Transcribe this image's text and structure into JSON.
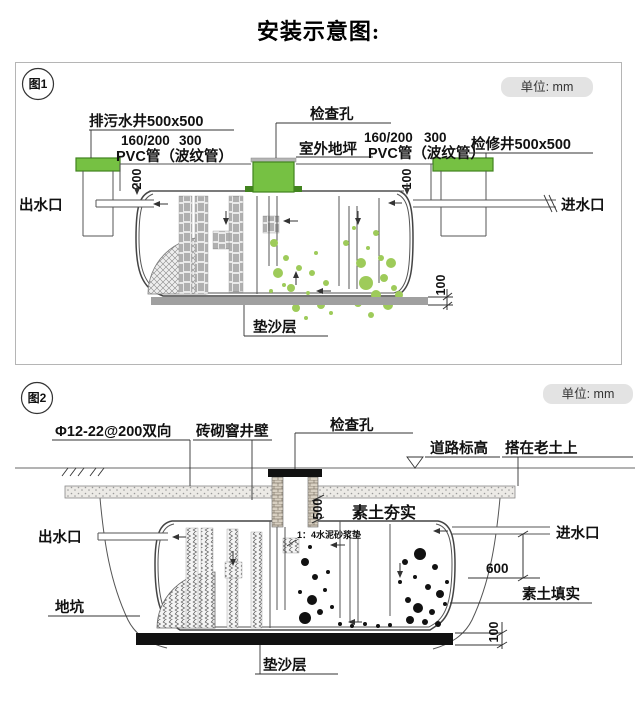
{
  "title": "安装示意图:",
  "fig1": {
    "tag": "图1",
    "unit_badge": "单位: mm",
    "labels": {
      "sewage_well": "排污水井500x500",
      "pvc_left_d1": "160/200",
      "pvc_left_d2": "300",
      "pvc_left": "PVC管（波纹管）",
      "inspection_hole": "检查孔",
      "outdoor_ground": "室外地坪",
      "pvc_right_d1": "160/200",
      "pvc_right_d2": "300",
      "pvc_right": "PVC管（波纹管）",
      "access_well": "检修井500x500",
      "outlet": "出水口",
      "inlet": "进水口",
      "sand_layer": "垫沙层"
    },
    "dims": {
      "d200": "200",
      "d100_top": "100",
      "d100_bottom": "100"
    }
  },
  "fig2": {
    "tag": "图2",
    "unit_badge": "单位: mm",
    "labels": {
      "rebar": "Φ12-22@200双向",
      "brick_wall": "砖砌窨井壁",
      "inspection_hole": "检查孔",
      "road_level": "道路标高",
      "on_old_soil": "搭在老土上",
      "compacted_soil": "素土夯实",
      "mortar_pad": "1：4水泥砂浆垫",
      "outlet": "出水口",
      "inlet": "进水口",
      "pit": "地坑",
      "soil_backfill": "素土填实",
      "sand_layer": "垫沙层"
    },
    "dims": {
      "d500": "500",
      "d600": "600",
      "d100": "100"
    }
  },
  "colors": {
    "cap_green": "#76c143",
    "cap_green_dark": "#41831f",
    "dot_green": "#9ecb5a",
    "slab_gray_fig1": "#a0a0a0",
    "slab_black_fig2": "#111111",
    "badge_bg": "#e3e3e3",
    "line": "#555555"
  }
}
